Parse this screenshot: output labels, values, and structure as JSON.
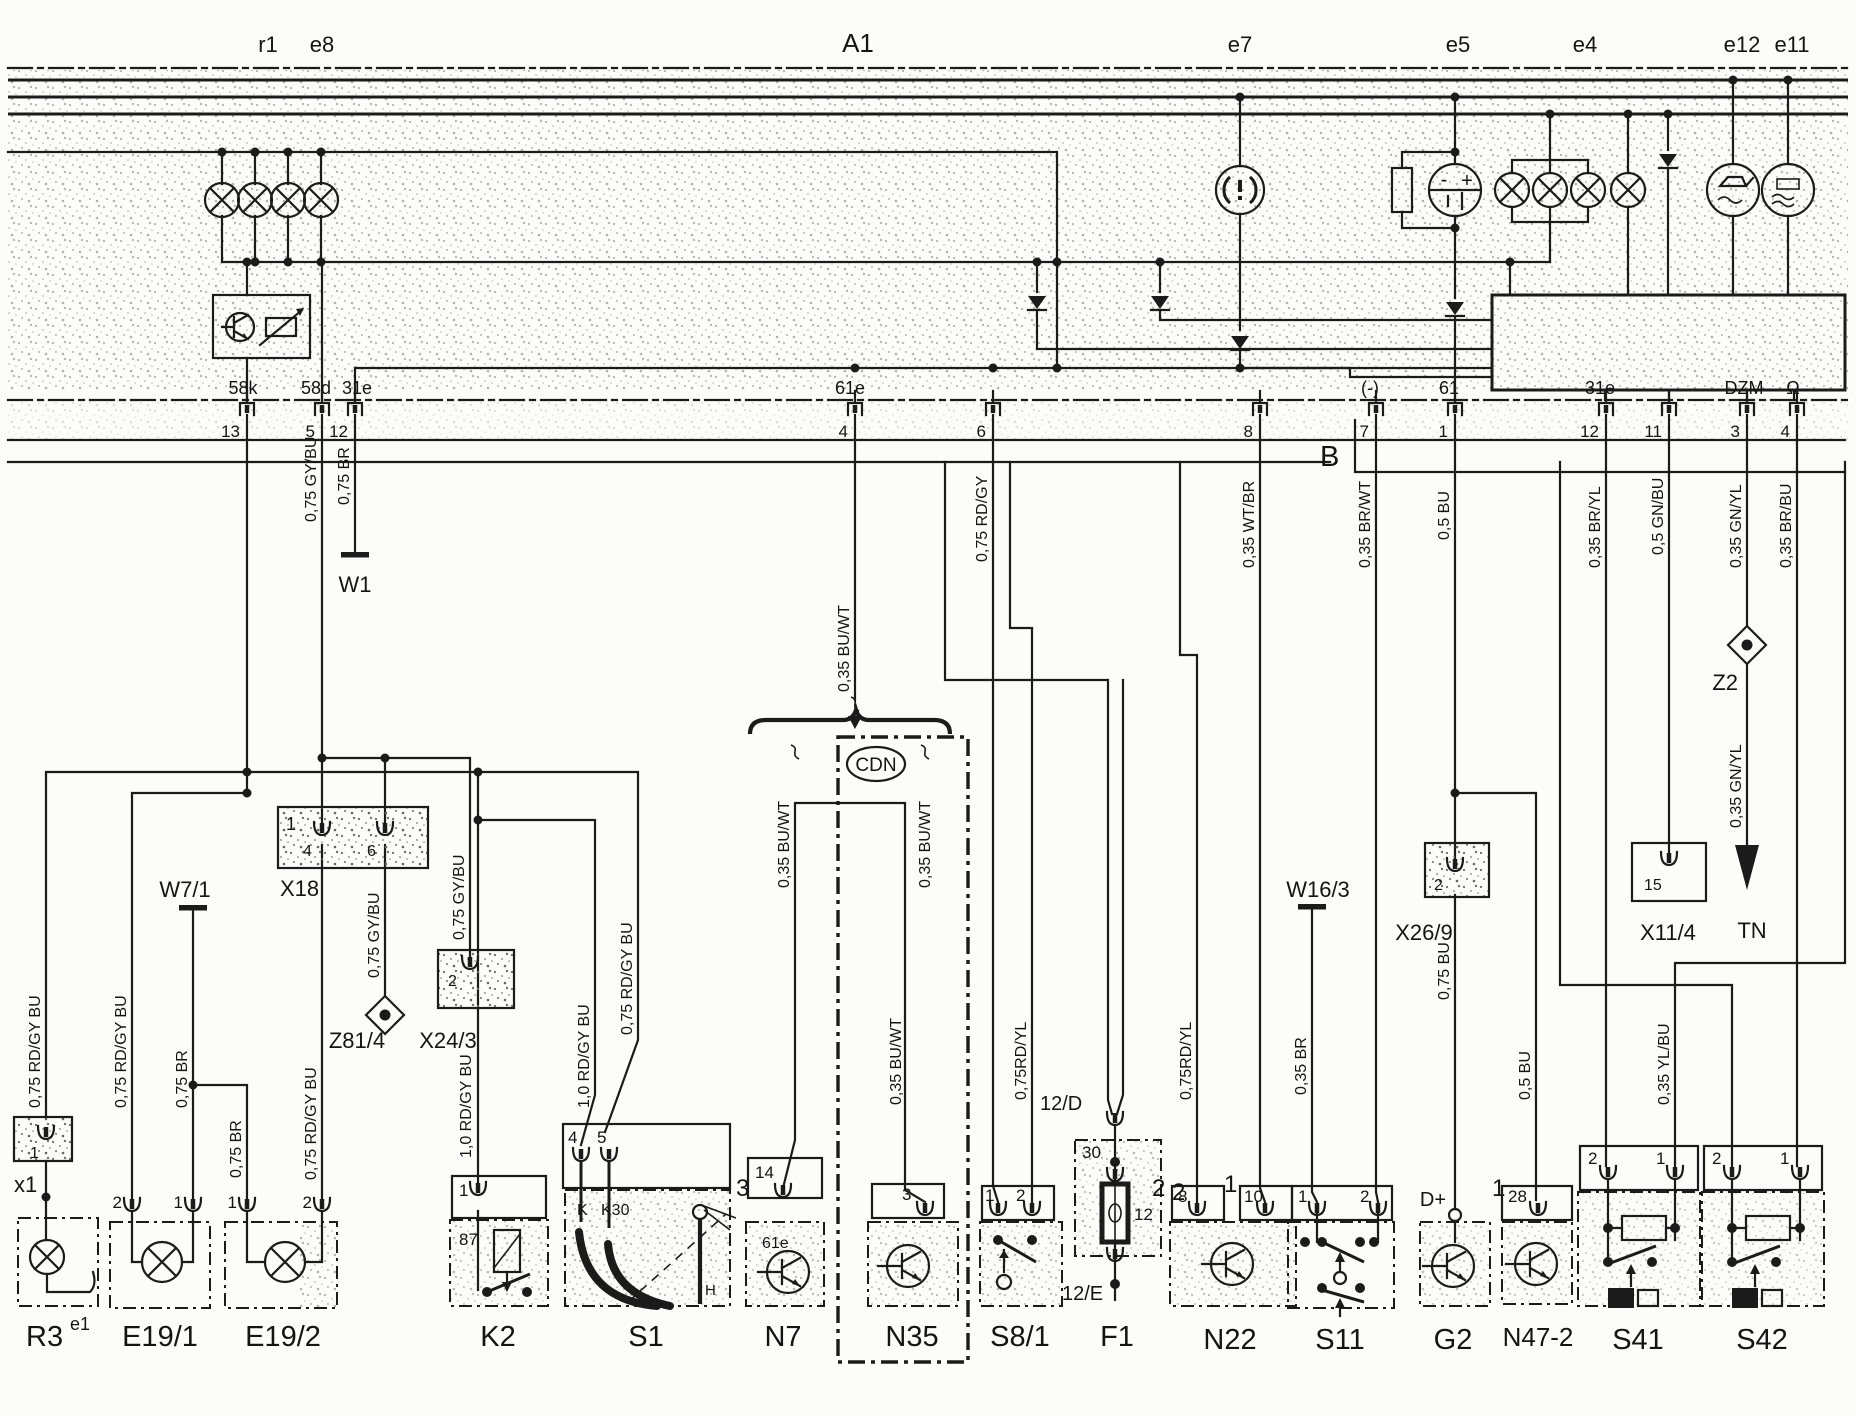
{
  "rail": {
    "r1": "r1",
    "e8": "e8",
    "a1": "A1",
    "e7": "e7",
    "e5": "e5",
    "e4": "e4",
    "e12": "e12",
    "e11": "e11"
  },
  "conn": {
    "b": "B",
    "t58k": "58k",
    "t58d": "58d",
    "t31el": "31e",
    "t61e": "61e",
    "tminus": "(-)",
    "t61": "61",
    "t31er": "31e",
    "tdzm": "DZM",
    "tohm": "Ω",
    "p13": "13",
    "p5": "5",
    "p12l": "12",
    "p4l": "4",
    "p6": "6",
    "p8": "8",
    "p7": "7",
    "p1": "1",
    "p12r": "12",
    "p11": "11",
    "p3": "3",
    "p4r": "4"
  },
  "wire": {
    "gybu": "0,75 GY/BU",
    "br": "0,75 BR",
    "buwt": "0,35 BU/WT",
    "rdgy": "0,75 RD/GY",
    "wtbr": "0,35 WT/BR",
    "brwt": "0,35 BR/WT",
    "bu05": "0,5 BU",
    "bryl": "0,35 BR/YL",
    "gnbu": "0,5 GN/BU",
    "gnyl": "0,35 GN/YL",
    "brbu": "0,35 BR/BU",
    "rdgybu75": "0,75 RD/GY BU",
    "rdgybu10": "1,0 RD/GY BU",
    "rdyl": "0,75RD/YL",
    "br035": "0,35 BR",
    "bu075": "0,75 BU",
    "ylbu": "0,35 YL/BU"
  },
  "comp": {
    "w1": "W1",
    "w71": "W7/1",
    "x18": "X18",
    "z814": "Z81/4",
    "x243": "X24/3",
    "x1": "x1",
    "r3": "R3",
    "r3sup": "e1",
    "e191": "E19/1",
    "e192": "E19/2",
    "k2": "K2",
    "s1": "S1",
    "n7": "N7",
    "n35": "N35",
    "cdn": "CDN",
    "s81": "S8/1",
    "f1": "F1",
    "f12d": "12/D",
    "f12e": "12/E",
    "n22": "N22",
    "s11": "S11",
    "w163": "W16/3",
    "x269": "X26/9",
    "g2": "G2",
    "dplus": "D+",
    "n472": "N47-2",
    "s41": "S41",
    "s42": "S42",
    "x114": "X11/4",
    "tn": "TN",
    "z2": "Z2"
  },
  "pin": {
    "x1_1": "1",
    "x18_1": "1",
    "x18_4": "4",
    "x18_6": "6",
    "x243_2": "2",
    "k2_1": "1",
    "k2_87": "87",
    "s1_4": "4",
    "s1_5": "5",
    "s1_k": "K",
    "s1_k30": "K30",
    "s1_3": "3",
    "s1_h": "H",
    "n7_14": "14",
    "n7_61e": "61e",
    "n35_3": "3",
    "s81_1": "1",
    "s81_2": "2",
    "f1_30": "30",
    "f1_12": "12",
    "f1_2": "2",
    "n22_2": "2",
    "n22_8": "8",
    "n22_1": "1",
    "n22_10": "10",
    "s11_1": "1",
    "s11_2": "2",
    "g2_1": "1",
    "n472_28": "28",
    "s41_2": "2",
    "s41_1": "1",
    "s42_2": "2",
    "s42_1": "1",
    "e191_2": "2",
    "e191_1": "1",
    "e192_1": "1",
    "e192_2": "2",
    "x269_2": "2",
    "x114_15": "15"
  }
}
